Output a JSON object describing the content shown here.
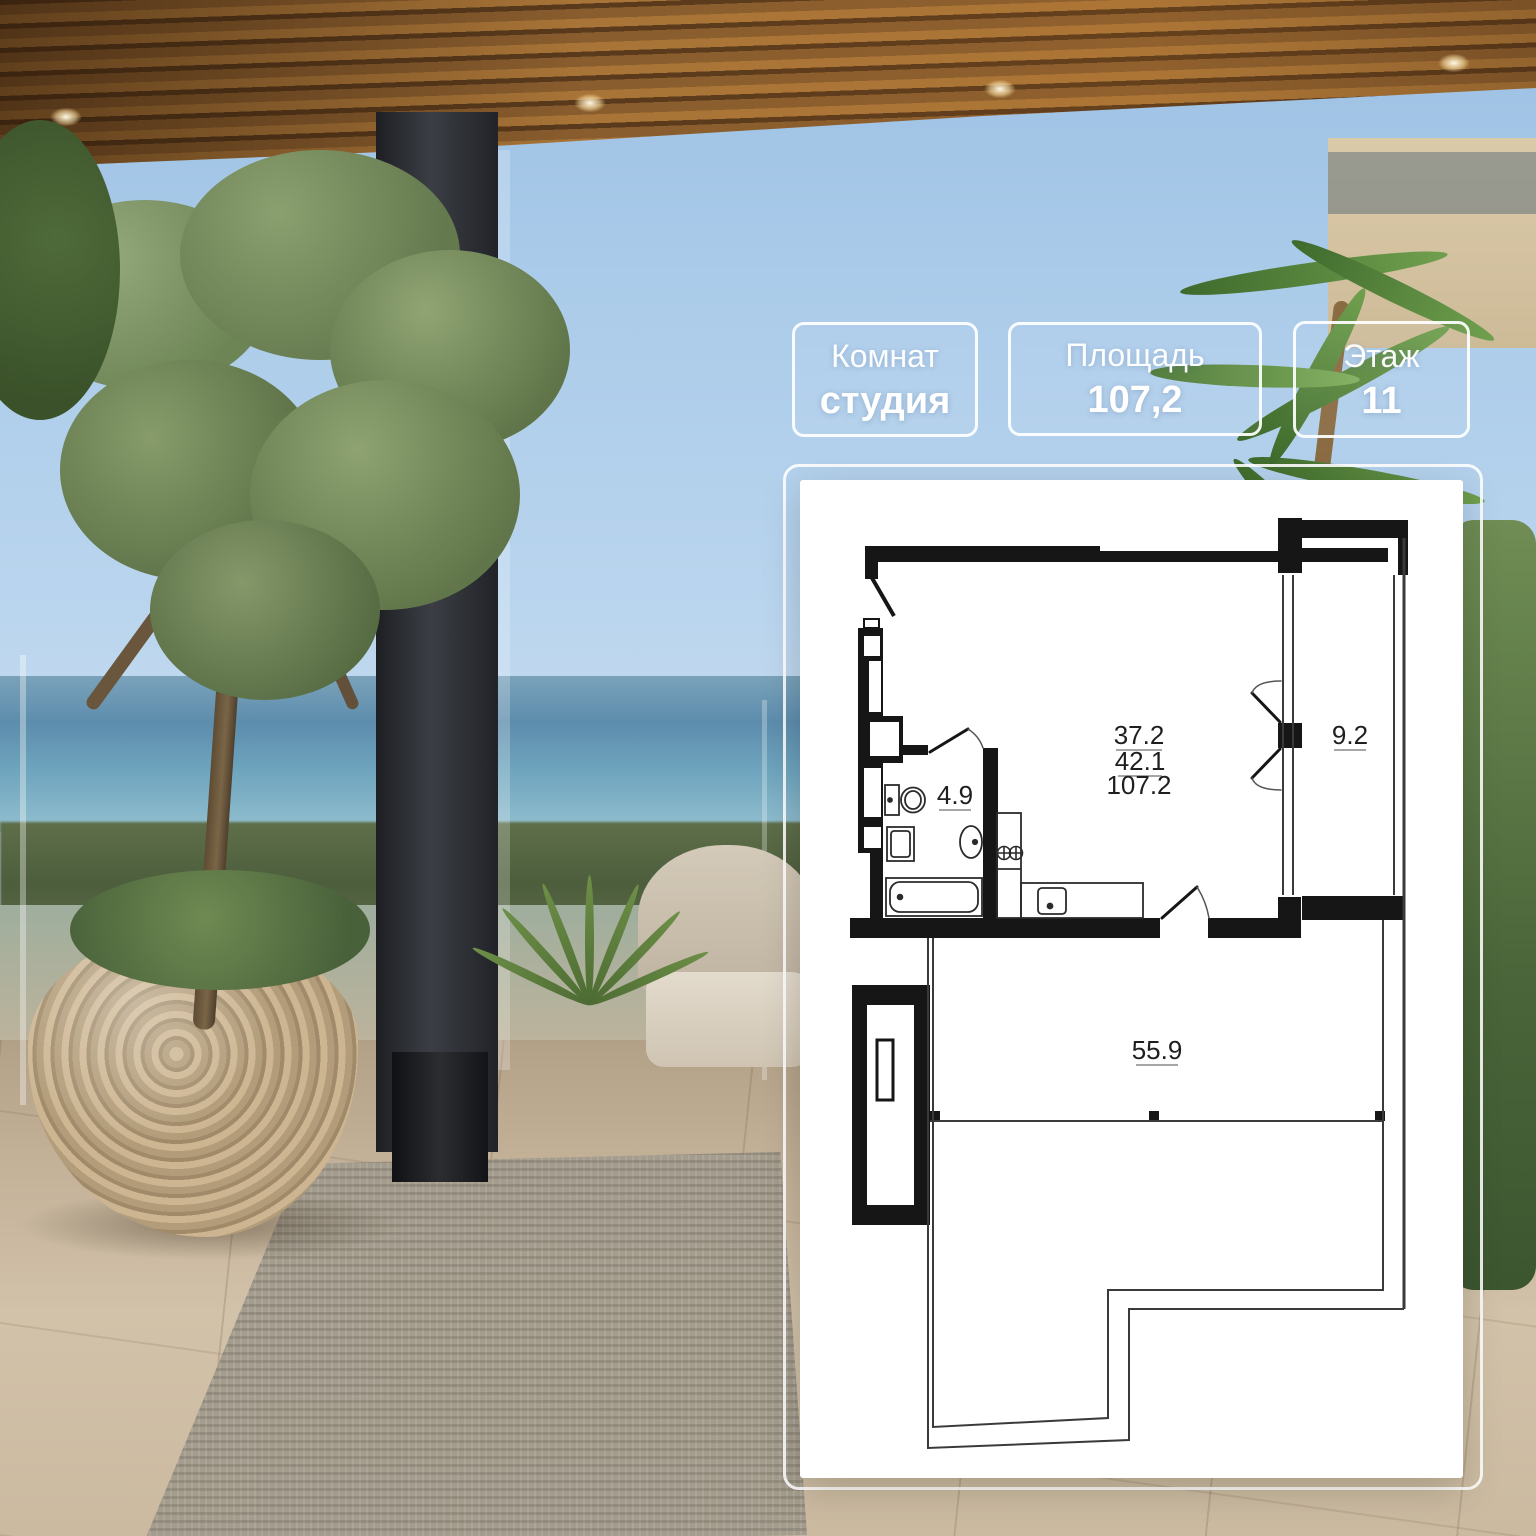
{
  "badges": [
    {
      "label": "Комнат",
      "value": "студия"
    },
    {
      "label": "Площадь",
      "value": "107,2"
    },
    {
      "label": "Этаж",
      "value": "11"
    }
  ],
  "floor_plan": {
    "areas": {
      "line1": "37.2",
      "line2": "42.1",
      "line3": "107.2",
      "bathroom": "4.9",
      "balcony": "9.2",
      "terrace": "55.9"
    }
  },
  "colors": {
    "wall": "#161616",
    "thin_line": "#3a3a3a",
    "card_bg": "#ffffff",
    "badge_border": "rgba(255,255,255,0.92)",
    "badge_text": "#ffffff"
  }
}
